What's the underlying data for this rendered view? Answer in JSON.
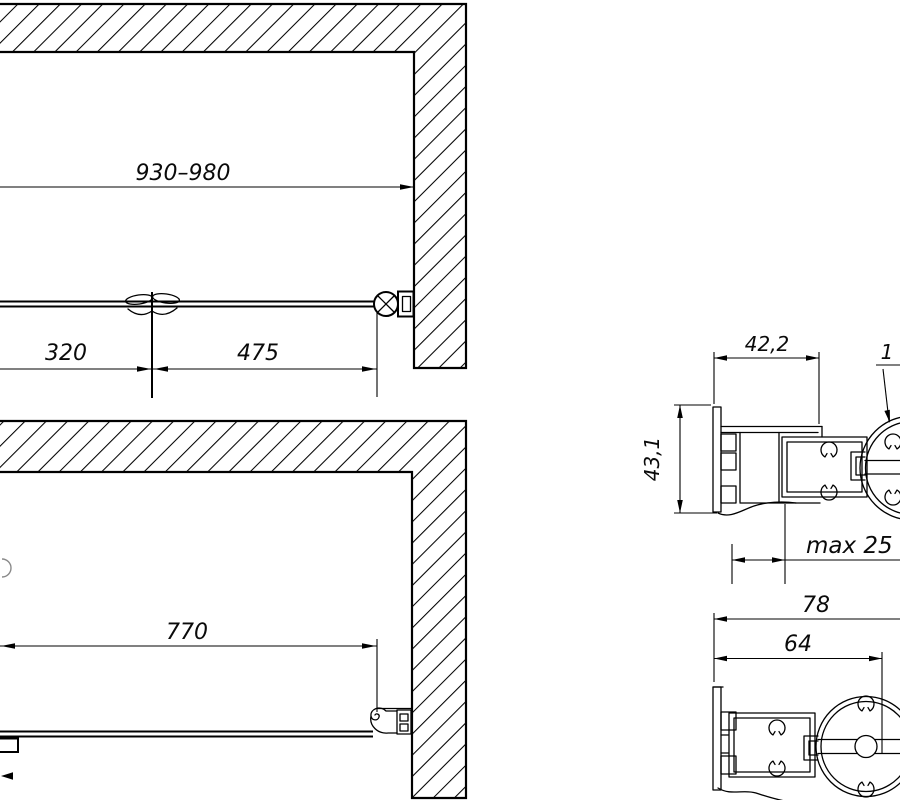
{
  "views": {
    "plan_open": {
      "overall_width": "930–980",
      "left_panel": "320",
      "right_panel": "475"
    },
    "plan_closed": {
      "door_width": "770"
    },
    "wall_profile": {
      "depth": "42,2",
      "height": "43,1",
      "adjustment": "max 25 мм",
      "callout": "1"
    },
    "hinge_profile": {
      "overall": "78",
      "to_axis": "64"
    }
  },
  "colors": {
    "line": "#000000",
    "background": "#ffffff"
  }
}
